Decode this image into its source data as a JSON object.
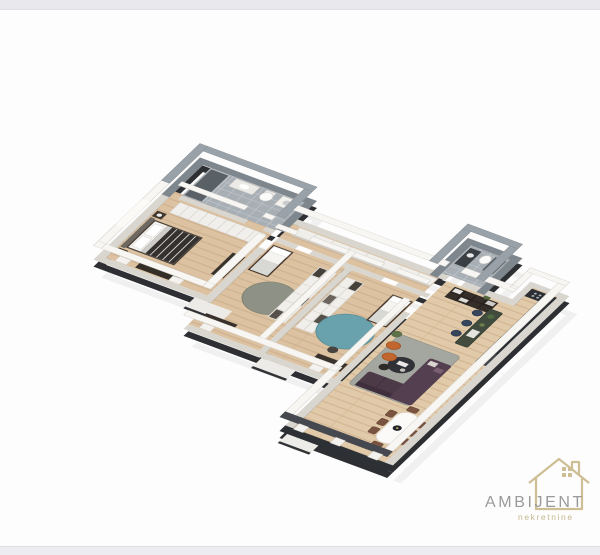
{
  "page": {
    "background": "#fdfdfd",
    "top_bar_color": "#e9e9ed",
    "bottom_bar_color": "#ededf1"
  },
  "logo": {
    "brand": "AMBIJENT",
    "tagline": "nekretnine",
    "brand_color": "#9a9a9a",
    "accent_color": "#c6b68c",
    "icon": "house-outline-icon"
  },
  "floorplan": {
    "description": "3D isometric render of a three-bedroom apartment, no text labels",
    "rooms": [
      "main-bathroom",
      "hallway-closet",
      "master-bedroom",
      "corridor-wardrobes",
      "kids-bedroom-1",
      "kids-bedroom-2",
      "wc",
      "kitchen",
      "living-room",
      "dining-area"
    ],
    "colors": {
      "wood": "#dcc2a0",
      "wood_living": "#e1caa9",
      "tile": "#a7aeb4",
      "wall_top": "#f7f6f2",
      "wall_face": "#d9d6d0",
      "wall_base": "#2d2f33",
      "rug_gray": "#8e9186",
      "rug_teal": "#69a2ad",
      "rug_living": "#a4a79f",
      "sofa": "#4c3a47",
      "sofa_chaise": "#543f50",
      "chair_orange": "#c2662f",
      "dining_chair": "#7a5440",
      "dining_table": "#fbfaf8",
      "island": "#414b3e",
      "stool": "#36465a",
      "kitchen_counter": "#2b2f33",
      "shelf_white": "#f1efeb",
      "furniture_dark": "#39322c",
      "bed_duvet": "#34312e",
      "shower": "#596066"
    }
  }
}
